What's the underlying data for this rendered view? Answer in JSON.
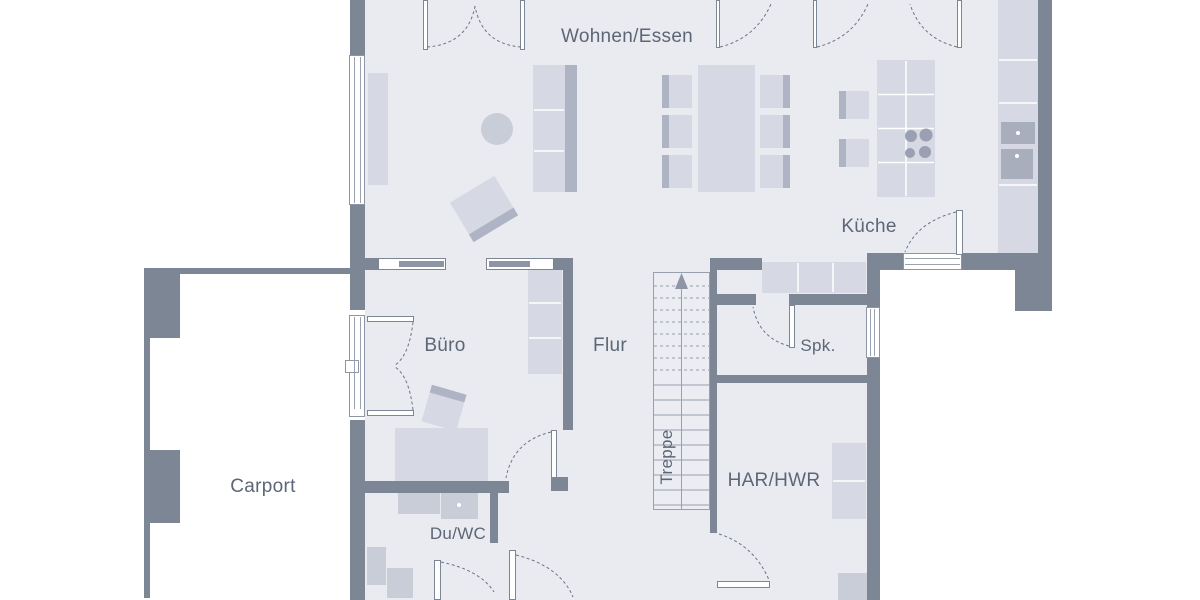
{
  "rooms": {
    "wohnen_essen": "Wohnen/Essen",
    "kueche": "Küche",
    "buero": "Büro",
    "flur": "Flur",
    "spk": "Spk.",
    "treppe": "Treppe",
    "har_hwr": "HAR/HWR",
    "du_wc": "Du/WC",
    "carport": "Carport"
  },
  "colors": {
    "wall": "#7d8694",
    "floor": "#e9ebf1",
    "outside": "#ffffff",
    "furniture_light": "#d6d9e3",
    "furniture_mid": "#c9cdd8",
    "furniture_dark": "#aeb4c3",
    "appliance": "#a9aebd",
    "line": "#8e96a5",
    "arc": "#6b7487",
    "text": "#5d6676"
  }
}
